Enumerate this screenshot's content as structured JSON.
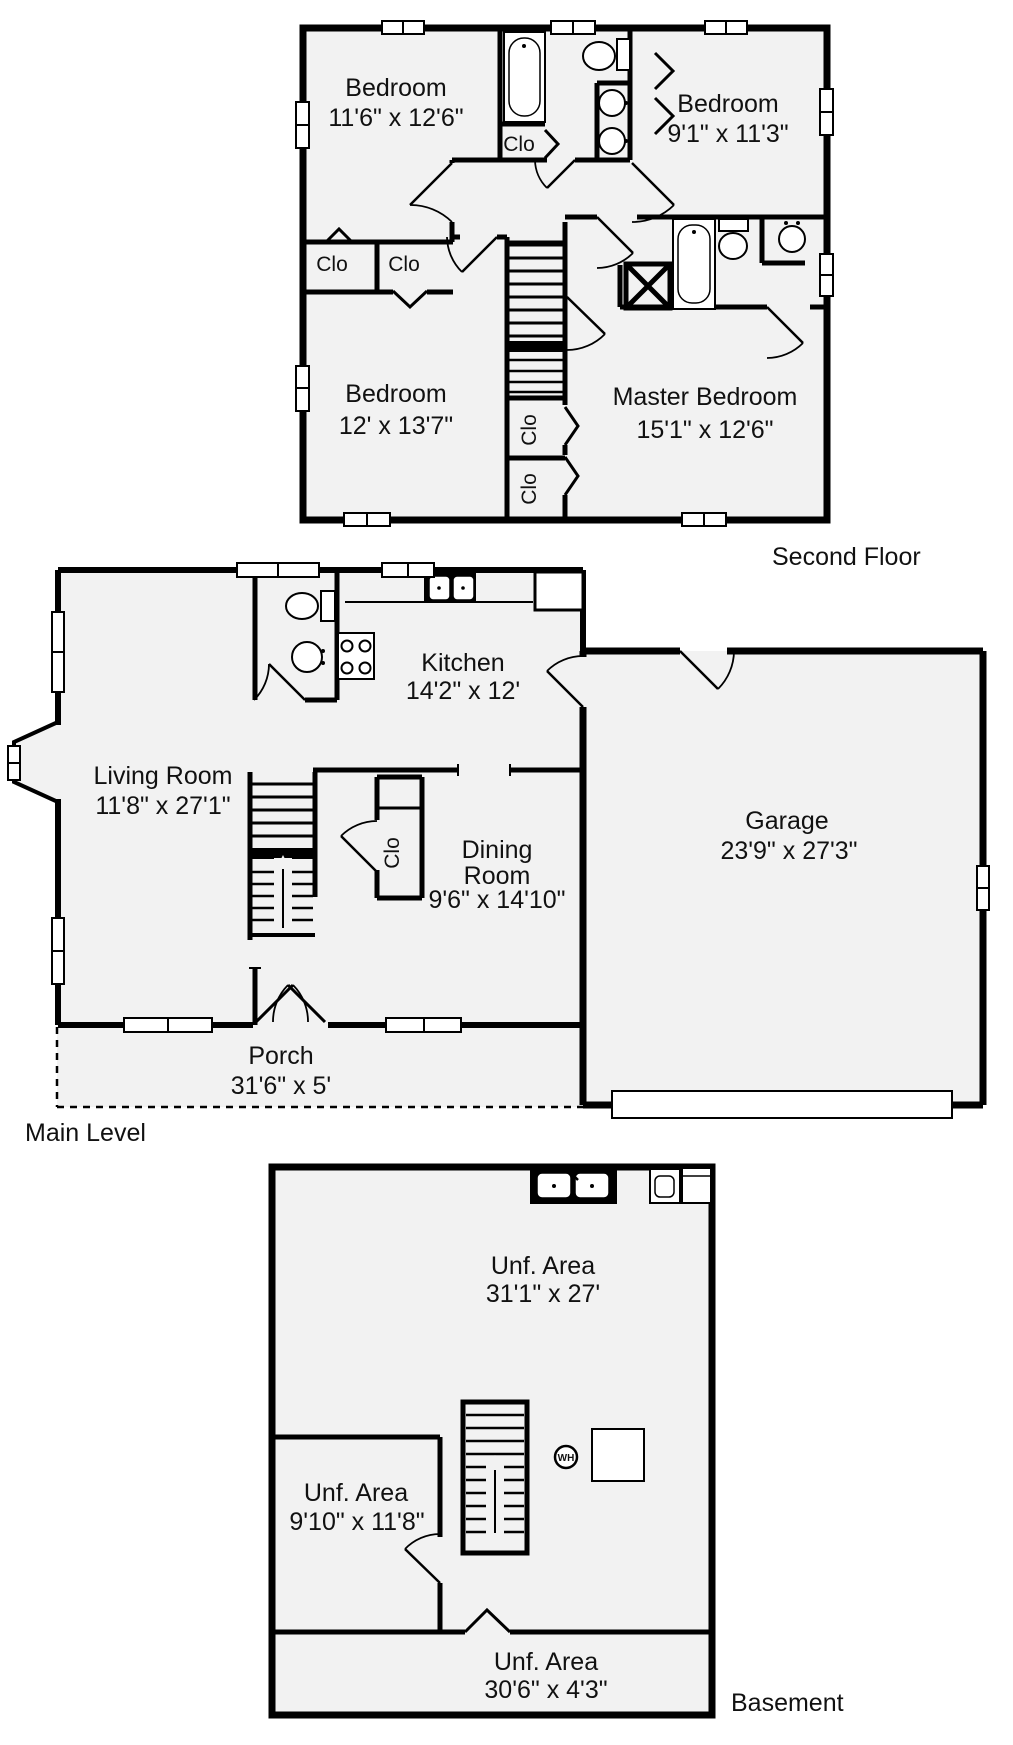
{
  "colors": {
    "wall": "#000000",
    "floor_fill": "#f2f2f2",
    "text": "#111111",
    "background": "#ffffff"
  },
  "floors": {
    "second": {
      "label": "Second Floor",
      "rooms": {
        "bedroom_top_left": {
          "name": "Bedroom",
          "dims": "11'6\" x 12'6\""
        },
        "bedroom_top_right": {
          "name": "Bedroom",
          "dims": "9'1\" x 11'3\""
        },
        "bedroom_bottom_left": {
          "name": "Bedroom",
          "dims": "12' x 13'7\""
        },
        "master_bedroom": {
          "name": "Master Bedroom",
          "dims": "15'1\" x 12'6\""
        }
      },
      "closets": {
        "under_tub": "Clo",
        "left_a": "Clo",
        "left_b": "Clo",
        "stair_a": "Clo",
        "stair_b": "Clo"
      }
    },
    "main": {
      "label": "Main Level",
      "rooms": {
        "living": {
          "name": "Living Room",
          "dims": "11'8\" x 27'1\""
        },
        "kitchen": {
          "name": "Kitchen",
          "dims": "14'2\" x 12'"
        },
        "dining": {
          "line1": "Dining",
          "line2": "Room",
          "dims": "9'6\" x 14'10\""
        },
        "garage": {
          "name": "Garage",
          "dims": "23'9\" x 27'3\""
        },
        "porch": {
          "name": "Porch",
          "dims": "31'6\" x 5'"
        }
      },
      "closets": {
        "dining": "Clo"
      }
    },
    "basement": {
      "label": "Basement",
      "rooms": {
        "unf_main": {
          "name": "Unf. Area",
          "dims": "31'1\" x 27'"
        },
        "unf_room": {
          "name": "Unf. Area",
          "dims": "9'10\" x 11'8\""
        },
        "unf_strip": {
          "name": "Unf. Area",
          "dims": "30'6\" x 4'3\""
        }
      },
      "water_heater_label": "WH"
    }
  }
}
